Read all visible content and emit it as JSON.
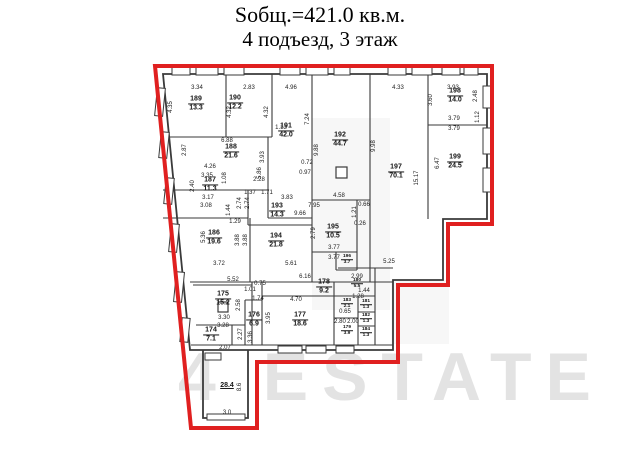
{
  "title": {
    "line1": "Sобщ.=421.0 кв.м.",
    "line2": "4 подъезд, 3 этаж"
  },
  "watermark": {
    "text": "4 ESTATE"
  },
  "colors": {
    "boundary_red": "#e02020",
    "wall_black": "#3a3a3a",
    "label_text": "#151515",
    "watermark_gray": "#e3e3e3"
  },
  "rooms": [
    {
      "num": "189",
      "area": "13.3",
      "x": 196,
      "y": 104
    },
    {
      "num": "190",
      "area": "12.2",
      "x": 235,
      "y": 103
    },
    {
      "num": "191",
      "area": "42.0",
      "x": 286,
      "y": 131
    },
    {
      "num": "192",
      "area": "44.7",
      "x": 340,
      "y": 140
    },
    {
      "num": "197",
      "area": "70.1",
      "x": 396,
      "y": 172
    },
    {
      "num": "198",
      "area": "14.0",
      "x": 455,
      "y": 96
    },
    {
      "num": "199",
      "area": "24.5",
      "x": 455,
      "y": 162
    },
    {
      "num": "188",
      "area": "21.6",
      "x": 231,
      "y": 152
    },
    {
      "num": "187",
      "area": "11.3",
      "x": 210,
      "y": 185
    },
    {
      "num": "193",
      "area": "14.3",
      "x": 277,
      "y": 211
    },
    {
      "num": "186",
      "area": "19.6",
      "x": 214,
      "y": 238
    },
    {
      "num": "194",
      "area": "21.8",
      "x": 276,
      "y": 241
    },
    {
      "num": "195",
      "area": "10.5",
      "x": 333,
      "y": 232
    },
    {
      "num": "196",
      "area": "3.7",
      "x": 347,
      "y": 260,
      "s": 1
    },
    {
      "num": "178",
      "area": "9.2",
      "x": 324,
      "y": 287
    },
    {
      "num": "175",
      "area": "15.2",
      "x": 223,
      "y": 299
    },
    {
      "num": "176",
      "area": "6.9",
      "x": 254,
      "y": 320
    },
    {
      "num": "177",
      "area": "18.6",
      "x": 300,
      "y": 320
    },
    {
      "num": "174",
      "area": "7.1",
      "x": 211,
      "y": 335
    },
    {
      "num": "179",
      "area": "3.9",
      "x": 347,
      "y": 331,
      "s": 1
    },
    {
      "num": "180",
      "area": "5.5",
      "x": 357,
      "y": 284,
      "s": 1
    },
    {
      "num": "183",
      "area": "2.1",
      "x": 347,
      "y": 304,
      "s": 1
    },
    {
      "num": "181",
      "area": "1.3",
      "x": 366,
      "y": 305,
      "s": 1
    },
    {
      "num": "182",
      "area": "1.3",
      "x": 366,
      "y": 319,
      "s": 1
    },
    {
      "num": "184",
      "area": "1.3",
      "x": 366,
      "y": 333,
      "s": 1
    },
    {
      "num": "",
      "area": "28.4",
      "x": 227,
      "y": 386
    }
  ],
  "dims": [
    {
      "t": "3.34",
      "x": 197,
      "y": 88
    },
    {
      "t": "2.83",
      "x": 249,
      "y": 88
    },
    {
      "t": "4.96",
      "x": 291,
      "y": 88
    },
    {
      "t": "4.33",
      "x": 398,
      "y": 88
    },
    {
      "t": "3.93",
      "x": 453,
      "y": 88
    },
    {
      "t": "4.35",
      "x": 171,
      "y": 107,
      "r": 1
    },
    {
      "t": "2.87",
      "x": 185,
      "y": 150,
      "r": 1
    },
    {
      "t": "2.40",
      "x": 193,
      "y": 186,
      "r": 1
    },
    {
      "t": "5.36",
      "x": 204,
      "y": 237,
      "r": 1
    },
    {
      "t": "4.32",
      "x": 230,
      "y": 112,
      "r": 1
    },
    {
      "t": "4.32",
      "x": 267,
      "y": 112,
      "r": 1
    },
    {
      "t": "1.13",
      "x": 281,
      "y": 128
    },
    {
      "t": "6.88",
      "x": 227,
      "y": 141
    },
    {
      "t": "7.24",
      "x": 308,
      "y": 119,
      "r": 1
    },
    {
      "t": "9.88",
      "x": 317,
      "y": 150,
      "r": 1
    },
    {
      "t": "9.98",
      "x": 374,
      "y": 146,
      "r": 1
    },
    {
      "t": "15.17",
      "x": 417,
      "y": 178,
      "r": 1
    },
    {
      "t": "3.60",
      "x": 431,
      "y": 100,
      "r": 1
    },
    {
      "t": "2.48",
      "x": 476,
      "y": 96,
      "r": 1
    },
    {
      "t": "1.12",
      "x": 478,
      "y": 117,
      "r": 1
    },
    {
      "t": "3.79",
      "x": 454,
      "y": 119
    },
    {
      "t": "3.79",
      "x": 454,
      "y": 129
    },
    {
      "t": "6.47",
      "x": 438,
      "y": 163,
      "r": 1
    },
    {
      "t": "4.26",
      "x": 210,
      "y": 167
    },
    {
      "t": "3.35",
      "x": 207,
      "y": 176
    },
    {
      "t": "1.08",
      "x": 225,
      "y": 178,
      "r": 1
    },
    {
      "t": "2.28",
      "x": 259,
      "y": 180
    },
    {
      "t": "1.37",
      "x": 250,
      "y": 193
    },
    {
      "t": "1.71",
      "x": 267,
      "y": 193
    },
    {
      "t": "3.17",
      "x": 208,
      "y": 198
    },
    {
      "t": "3.08",
      "x": 206,
      "y": 206
    },
    {
      "t": "2.74",
      "x": 240,
      "y": 203,
      "r": 1
    },
    {
      "t": "2.74",
      "x": 248,
      "y": 203,
      "r": 1
    },
    {
      "t": "1.44",
      "x": 229,
      "y": 210,
      "r": 1
    },
    {
      "t": "1.29",
      "x": 235,
      "y": 222
    },
    {
      "t": "3.93",
      "x": 263,
      "y": 157,
      "r": 1
    },
    {
      "t": "5.86",
      "x": 260,
      "y": 173,
      "r": 1
    },
    {
      "t": "0.72",
      "x": 307,
      "y": 163
    },
    {
      "t": "0.97",
      "x": 305,
      "y": 173
    },
    {
      "t": "3.83",
      "x": 287,
      "y": 198
    },
    {
      "t": "4.58",
      "x": 339,
      "y": 196
    },
    {
      "t": "7.95",
      "x": 314,
      "y": 206
    },
    {
      "t": "9.66",
      "x": 300,
      "y": 214
    },
    {
      "t": "0.66",
      "x": 364,
      "y": 205
    },
    {
      "t": "1.21",
      "x": 355,
      "y": 212,
      "r": 1
    },
    {
      "t": "0.26",
      "x": 360,
      "y": 224
    },
    {
      "t": "2.79",
      "x": 314,
      "y": 233,
      "r": 1
    },
    {
      "t": "3.77",
      "x": 334,
      "y": 248
    },
    {
      "t": "3.77",
      "x": 334,
      "y": 258
    },
    {
      "t": "5.25",
      "x": 389,
      "y": 262
    },
    {
      "t": "3.88",
      "x": 238,
      "y": 240,
      "r": 1
    },
    {
      "t": "3.88",
      "x": 246,
      "y": 240,
      "r": 1
    },
    {
      "t": "3.72",
      "x": 219,
      "y": 264
    },
    {
      "t": "5.61",
      "x": 291,
      "y": 264
    },
    {
      "t": "5.52",
      "x": 233,
      "y": 280
    },
    {
      "t": "6.16",
      "x": 305,
      "y": 277
    },
    {
      "t": "0.75",
      "x": 260,
      "y": 284
    },
    {
      "t": "1.01",
      "x": 250,
      "y": 290
    },
    {
      "t": "1.74",
      "x": 258,
      "y": 299
    },
    {
      "t": "4.70",
      "x": 296,
      "y": 300
    },
    {
      "t": "3.30",
      "x": 224,
      "y": 318
    },
    {
      "t": "3.28",
      "x": 223,
      "y": 326
    },
    {
      "t": "2.58",
      "x": 239,
      "y": 305,
      "r": 1
    },
    {
      "t": "2.27",
      "x": 241,
      "y": 334,
      "r": 1
    },
    {
      "t": "3.36",
      "x": 251,
      "y": 337,
      "r": 1
    },
    {
      "t": "3.95",
      "x": 269,
      "y": 318,
      "r": 1
    },
    {
      "t": "2.07",
      "x": 225,
      "y": 348
    },
    {
      "t": "2.99",
      "x": 357,
      "y": 277
    },
    {
      "t": "1.28",
      "x": 358,
      "y": 297
    },
    {
      "t": "1.44",
      "x": 364,
      "y": 291
    },
    {
      "t": "0.65",
      "x": 345,
      "y": 312
    },
    {
      "t": "2.80",
      "x": 340,
      "y": 322
    },
    {
      "t": "2.00",
      "x": 353,
      "y": 322
    },
    {
      "t": "8.6",
      "x": 240,
      "y": 387,
      "r": 1
    },
    {
      "t": "3.0",
      "x": 227,
      "y": 413
    }
  ]
}
